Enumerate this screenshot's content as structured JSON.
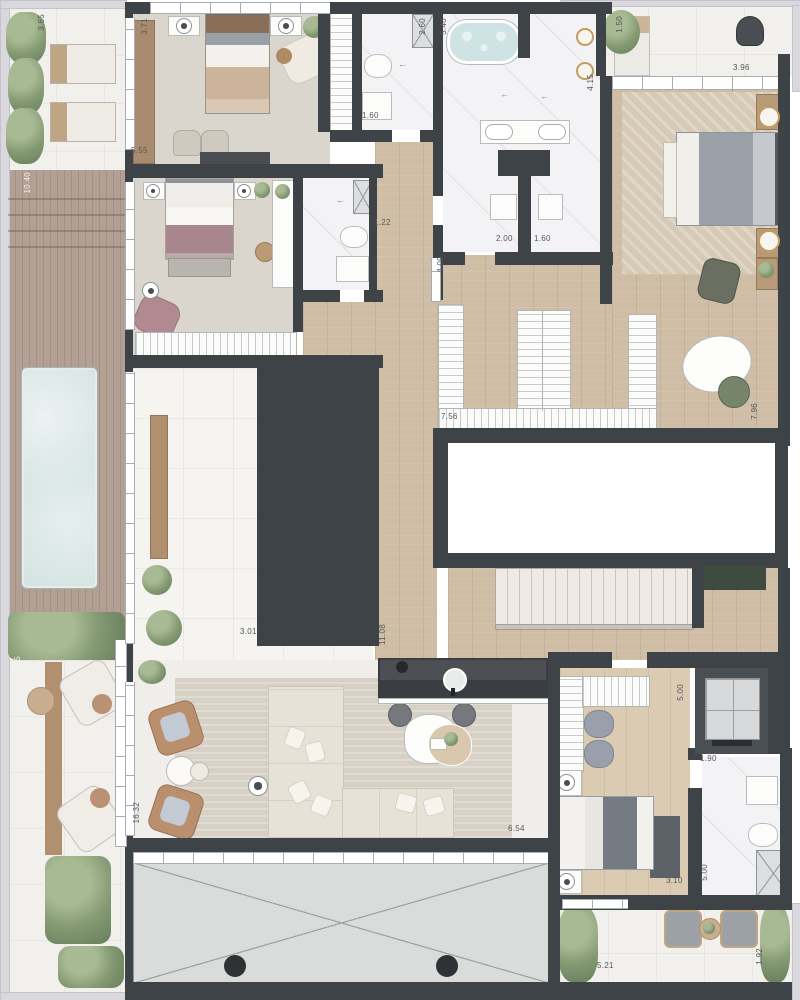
{
  "meta": {
    "description": "Residential penthouse floor plan, top view, furnished"
  },
  "colors": {
    "wall": "#3e4347",
    "wood_floor": "#cfbda6",
    "marble": "#f3f3f5",
    "deck": "#b3a094",
    "pool": "#d5e4e2",
    "greenery": "#839972",
    "void_fill": "#dcdedf",
    "cabinet_green": "#3f4b3f",
    "leather_tan": "#ba8f6e",
    "mauve": "#a9868d",
    "gold": "#c29d5f"
  },
  "dimensions": [
    {
      "text": "3.65",
      "x": 38,
      "y": 14,
      "v": true,
      "light": false
    },
    {
      "text": "3.71",
      "x": 141,
      "y": 18,
      "v": true,
      "light": false
    },
    {
      "text": "2.60",
      "x": 419,
      "y": 18,
      "v": true,
      "light": false
    },
    {
      "text": "5.40",
      "x": 440,
      "y": 18,
      "v": true,
      "light": false
    },
    {
      "text": "1.50",
      "x": 616,
      "y": 16,
      "v": true,
      "light": false
    },
    {
      "text": "4.15",
      "x": 587,
      "y": 74,
      "v": true,
      "light": false
    },
    {
      "text": "3.96",
      "x": 733,
      "y": 64,
      "v": false,
      "light": false
    },
    {
      "text": "1.60",
      "x": 362,
      "y": 112,
      "v": false,
      "light": false
    },
    {
      "text": "5.55",
      "x": 131,
      "y": 147,
      "v": false,
      "light": false
    },
    {
      "text": "1.22",
      "x": 374,
      "y": 219,
      "v": false,
      "light": false
    },
    {
      "text": "2.00",
      "x": 496,
      "y": 235,
      "v": false,
      "light": false
    },
    {
      "text": "1.60",
      "x": 534,
      "y": 235,
      "v": false,
      "light": false
    },
    {
      "text": "4.09",
      "x": 437,
      "y": 256,
      "v": true,
      "light": false
    },
    {
      "text": "10.40",
      "x": 24,
      "y": 172,
      "v": true,
      "light": true
    },
    {
      "text": "7.56",
      "x": 441,
      "y": 413,
      "v": false,
      "light": false
    },
    {
      "text": "7.96",
      "x": 751,
      "y": 403,
      "v": true,
      "light": false
    },
    {
      "text": "3.01",
      "x": 240,
      "y": 628,
      "v": false,
      "light": false
    },
    {
      "text": "11.08",
      "x": 379,
      "y": 624,
      "v": true,
      "light": false
    },
    {
      "text": "9.45",
      "x": 14,
      "y": 656,
      "v": true,
      "light": true
    },
    {
      "text": "5.00",
      "x": 677,
      "y": 684,
      "v": true,
      "light": false
    },
    {
      "text": "1.90",
      "x": 700,
      "y": 755,
      "v": false,
      "light": false
    },
    {
      "text": "16.32",
      "x": 133,
      "y": 802,
      "v": true,
      "light": false
    },
    {
      "text": "6.54",
      "x": 508,
      "y": 825,
      "v": false,
      "light": false
    },
    {
      "text": "3.10",
      "x": 666,
      "y": 877,
      "v": false,
      "light": false
    },
    {
      "text": "5.00",
      "x": 701,
      "y": 864,
      "v": true,
      "light": false
    },
    {
      "text": "15.68",
      "x": 20,
      "y": 972,
      "v": false,
      "light": true
    },
    {
      "text": "5.21",
      "x": 597,
      "y": 962,
      "v": false,
      "light": false
    },
    {
      "text": "1.92",
      "x": 756,
      "y": 948,
      "v": true,
      "light": false
    }
  ]
}
